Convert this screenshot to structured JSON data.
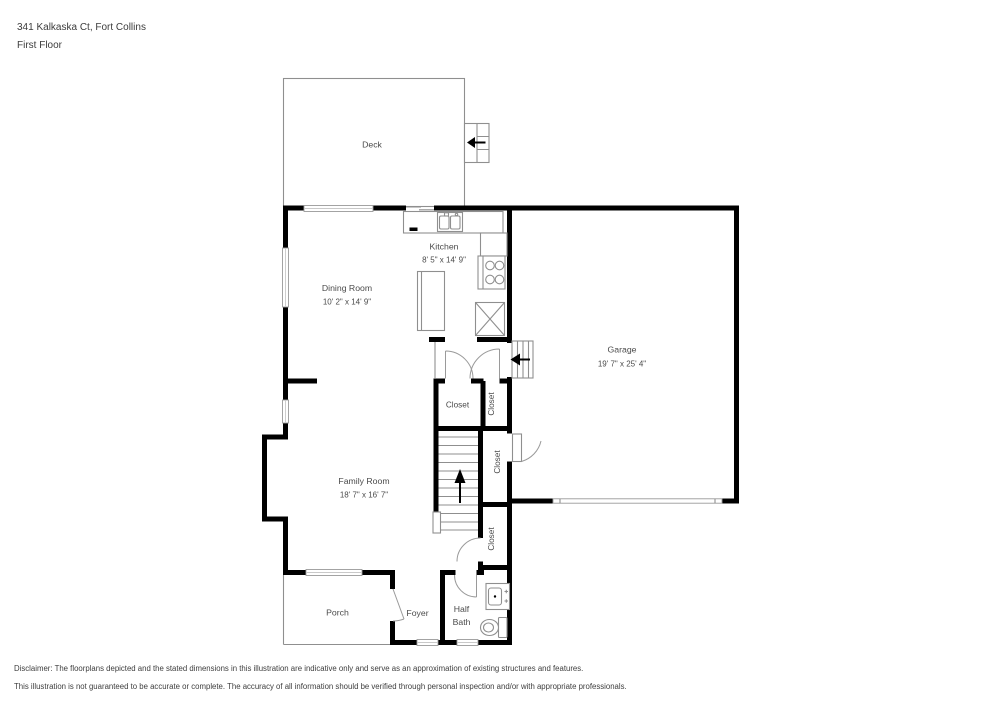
{
  "header": {
    "address": "341 Kalkaska Ct, Fort Collins",
    "floor_label": "First Floor"
  },
  "rooms": {
    "deck": {
      "name": "Deck"
    },
    "kitchen": {
      "name": "Kitchen",
      "dims": "8' 5\" x 14' 9\""
    },
    "dining_room": {
      "name": "Dining Room",
      "dims": "10' 2\" x 14' 9\""
    },
    "garage": {
      "name": "Garage",
      "dims": "19' 7\" x 25' 4\""
    },
    "family_room": {
      "name": "Family Room",
      "dims": "18' 7\" x 16' 7\""
    },
    "porch": {
      "name": "Porch"
    },
    "foyer": {
      "name": "Foyer"
    },
    "half_bath": {
      "line1": "Half",
      "line2": "Bath"
    },
    "closets": [
      "Closet",
      "Closet",
      "Closet",
      "Closet"
    ]
  },
  "icons": {
    "stairs_direction": "up-arrow",
    "garage_entry_steps": "left-arrow",
    "deck_steps": "left-arrow"
  },
  "colors": {
    "wall": "#000000",
    "thin_line": "#8f8f8f",
    "label_text": "#4a4a4a"
  },
  "disclaimer": {
    "line1": "Disclaimer: The floorplans depicted and the stated dimensions in this illustration are indicative only and serve as an approximation of existing structures and features.",
    "line2": "This illustration is not guaranteed to be accurate or complete. The accuracy of all information should be verified through personal inspection and/or with appropriate professionals."
  }
}
